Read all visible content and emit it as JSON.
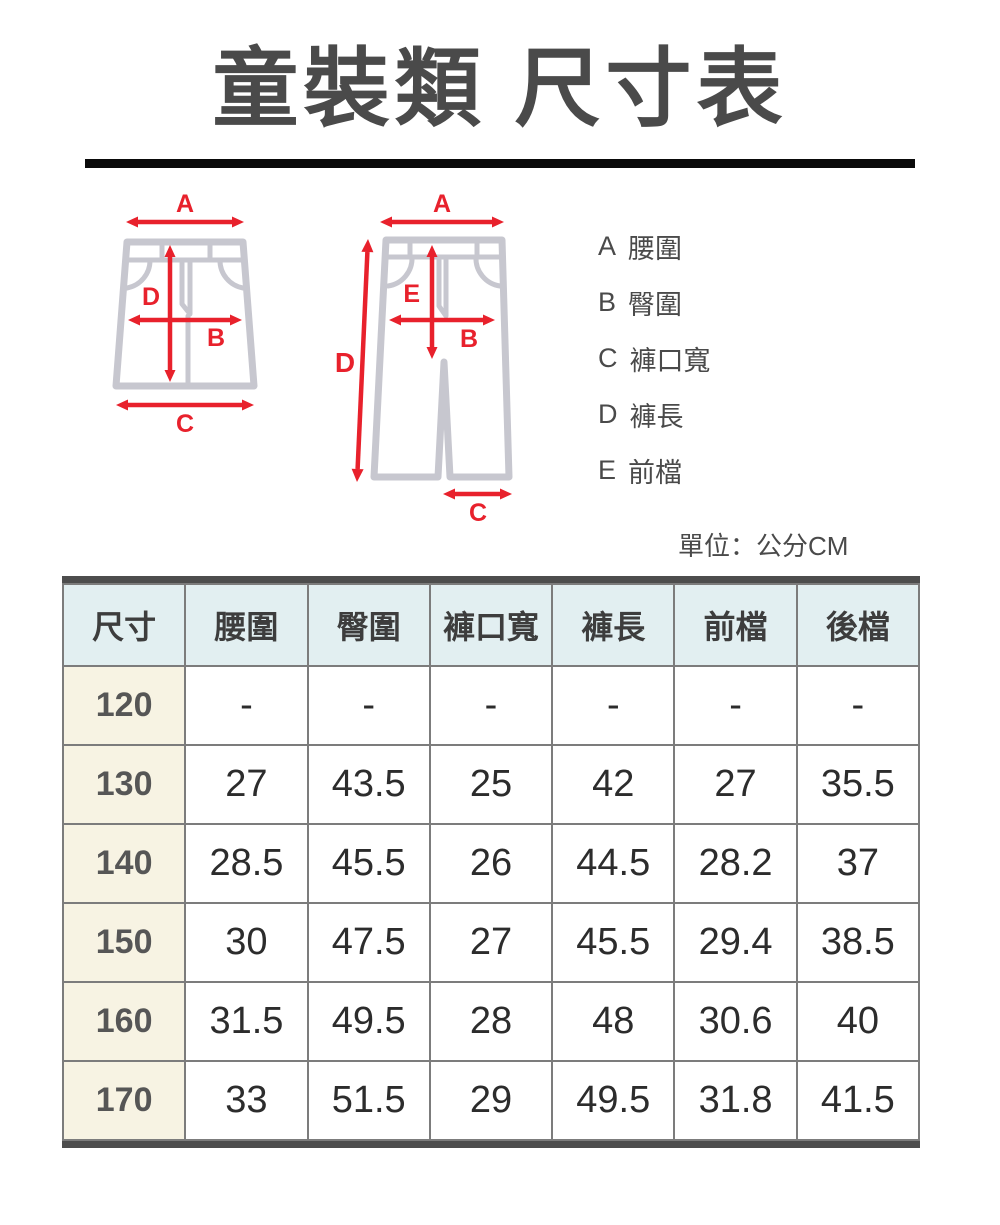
{
  "title": "童裝類 尺寸表",
  "legend": {
    "items": [
      {
        "letter": "A",
        "label": "腰圍"
      },
      {
        "letter": "B",
        "label": "臀圍"
      },
      {
        "letter": "C",
        "label": "褲口寬"
      },
      {
        "letter": "D",
        "label": "褲長"
      },
      {
        "letter": "E",
        "label": "前檔"
      }
    ]
  },
  "unit_note": "單位：公分CM",
  "diagram": {
    "shorts": {
      "a": "A",
      "b": "B",
      "c": "C",
      "d": "D"
    },
    "pants": {
      "a": "A",
      "b": "B",
      "c": "C",
      "d": "D",
      "e": "E"
    }
  },
  "table": {
    "headers": [
      "尺寸",
      "腰圍",
      "臀圍",
      "褲口寬",
      "褲長",
      "前檔",
      "後檔"
    ],
    "rows": [
      {
        "size": "120",
        "values": [
          "-",
          "-",
          "-",
          "-",
          "-",
          "-"
        ]
      },
      {
        "size": "130",
        "values": [
          "27",
          "43.5",
          "25",
          "42",
          "27",
          "35.5"
        ]
      },
      {
        "size": "140",
        "values": [
          "28.5",
          "45.5",
          "26",
          "44.5",
          "28.2",
          "37"
        ]
      },
      {
        "size": "150",
        "values": [
          "30",
          "47.5",
          "27",
          "45.5",
          "29.4",
          "38.5"
        ]
      },
      {
        "size": "160",
        "values": [
          "31.5",
          "49.5",
          "28",
          "48",
          "30.6",
          "40"
        ]
      },
      {
        "size": "170",
        "values": [
          "33",
          "51.5",
          "29",
          "49.5",
          "31.8",
          "41.5"
        ]
      }
    ]
  },
  "colors": {
    "arrow_red": "#e8212c",
    "garment_gray": "#c7c7cf",
    "header_bg": "#e2eff1",
    "size_column_bg": "#f7f3e3",
    "text_dark": "#4a4a4a",
    "thick_border": "#4d4d4d"
  }
}
